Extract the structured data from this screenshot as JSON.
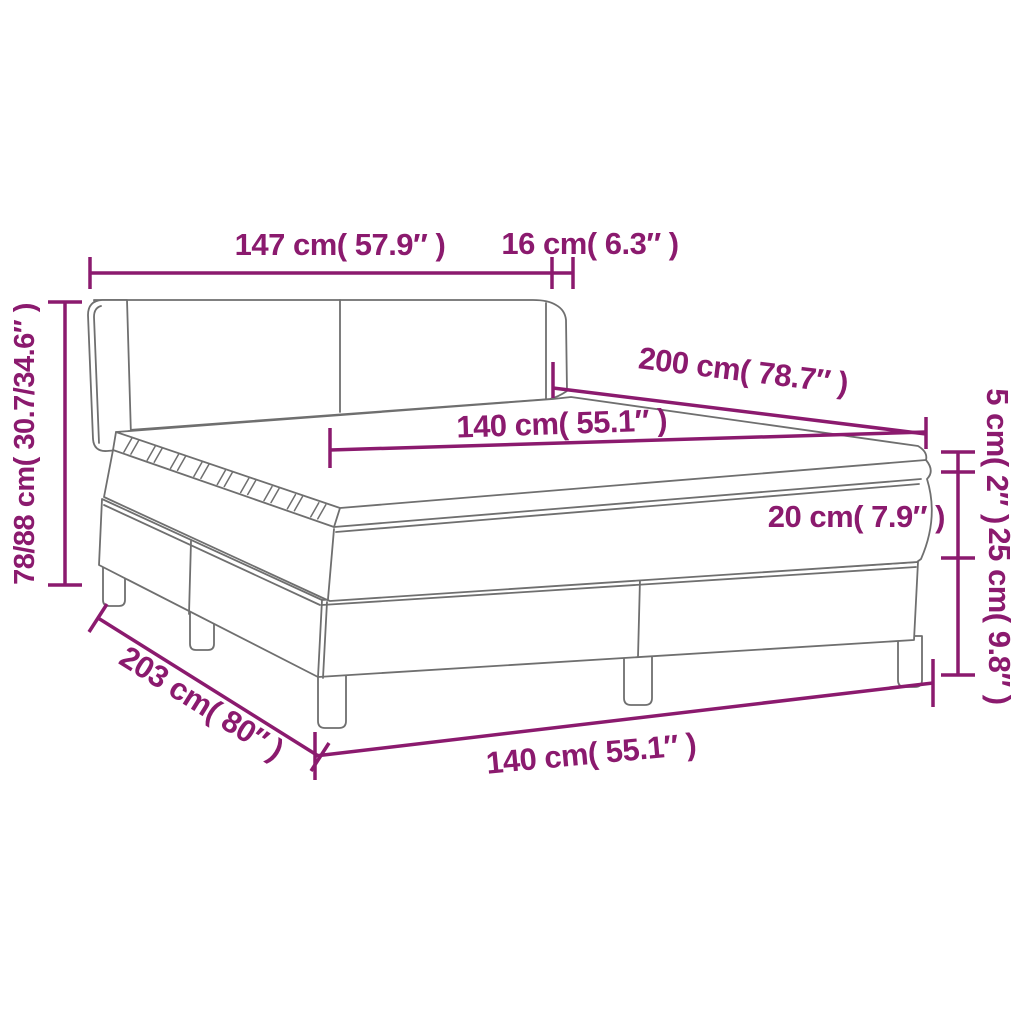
{
  "diagram": {
    "description": "Dimension diagram of a box spring bed with winged headboard, mattress and pillow top, on six legs",
    "colors": {
      "dimension_lines": "#8B1A6E",
      "bed_outline": "#6F6F6F",
      "background": "#FFFFFF"
    },
    "labels": {
      "headboard_width": "147 cm( 57.9″ )",
      "headboard_side_depth": "16 cm( 6.3″ )",
      "height_range": "78/88 cm( 30.7/34.6″ )",
      "bed_length": "200 cm( 78.7″ )",
      "mattress_width": "140 cm( 55.1″ )",
      "topper_thickness": "5 cm( 2″ )",
      "mattress_thickness": "20 cm( 7.9″ )",
      "base_height": "25 cm( 9.8″ )",
      "total_length": "203 cm( 80″ )",
      "base_width": "140 cm( 55.1″ )"
    }
  }
}
